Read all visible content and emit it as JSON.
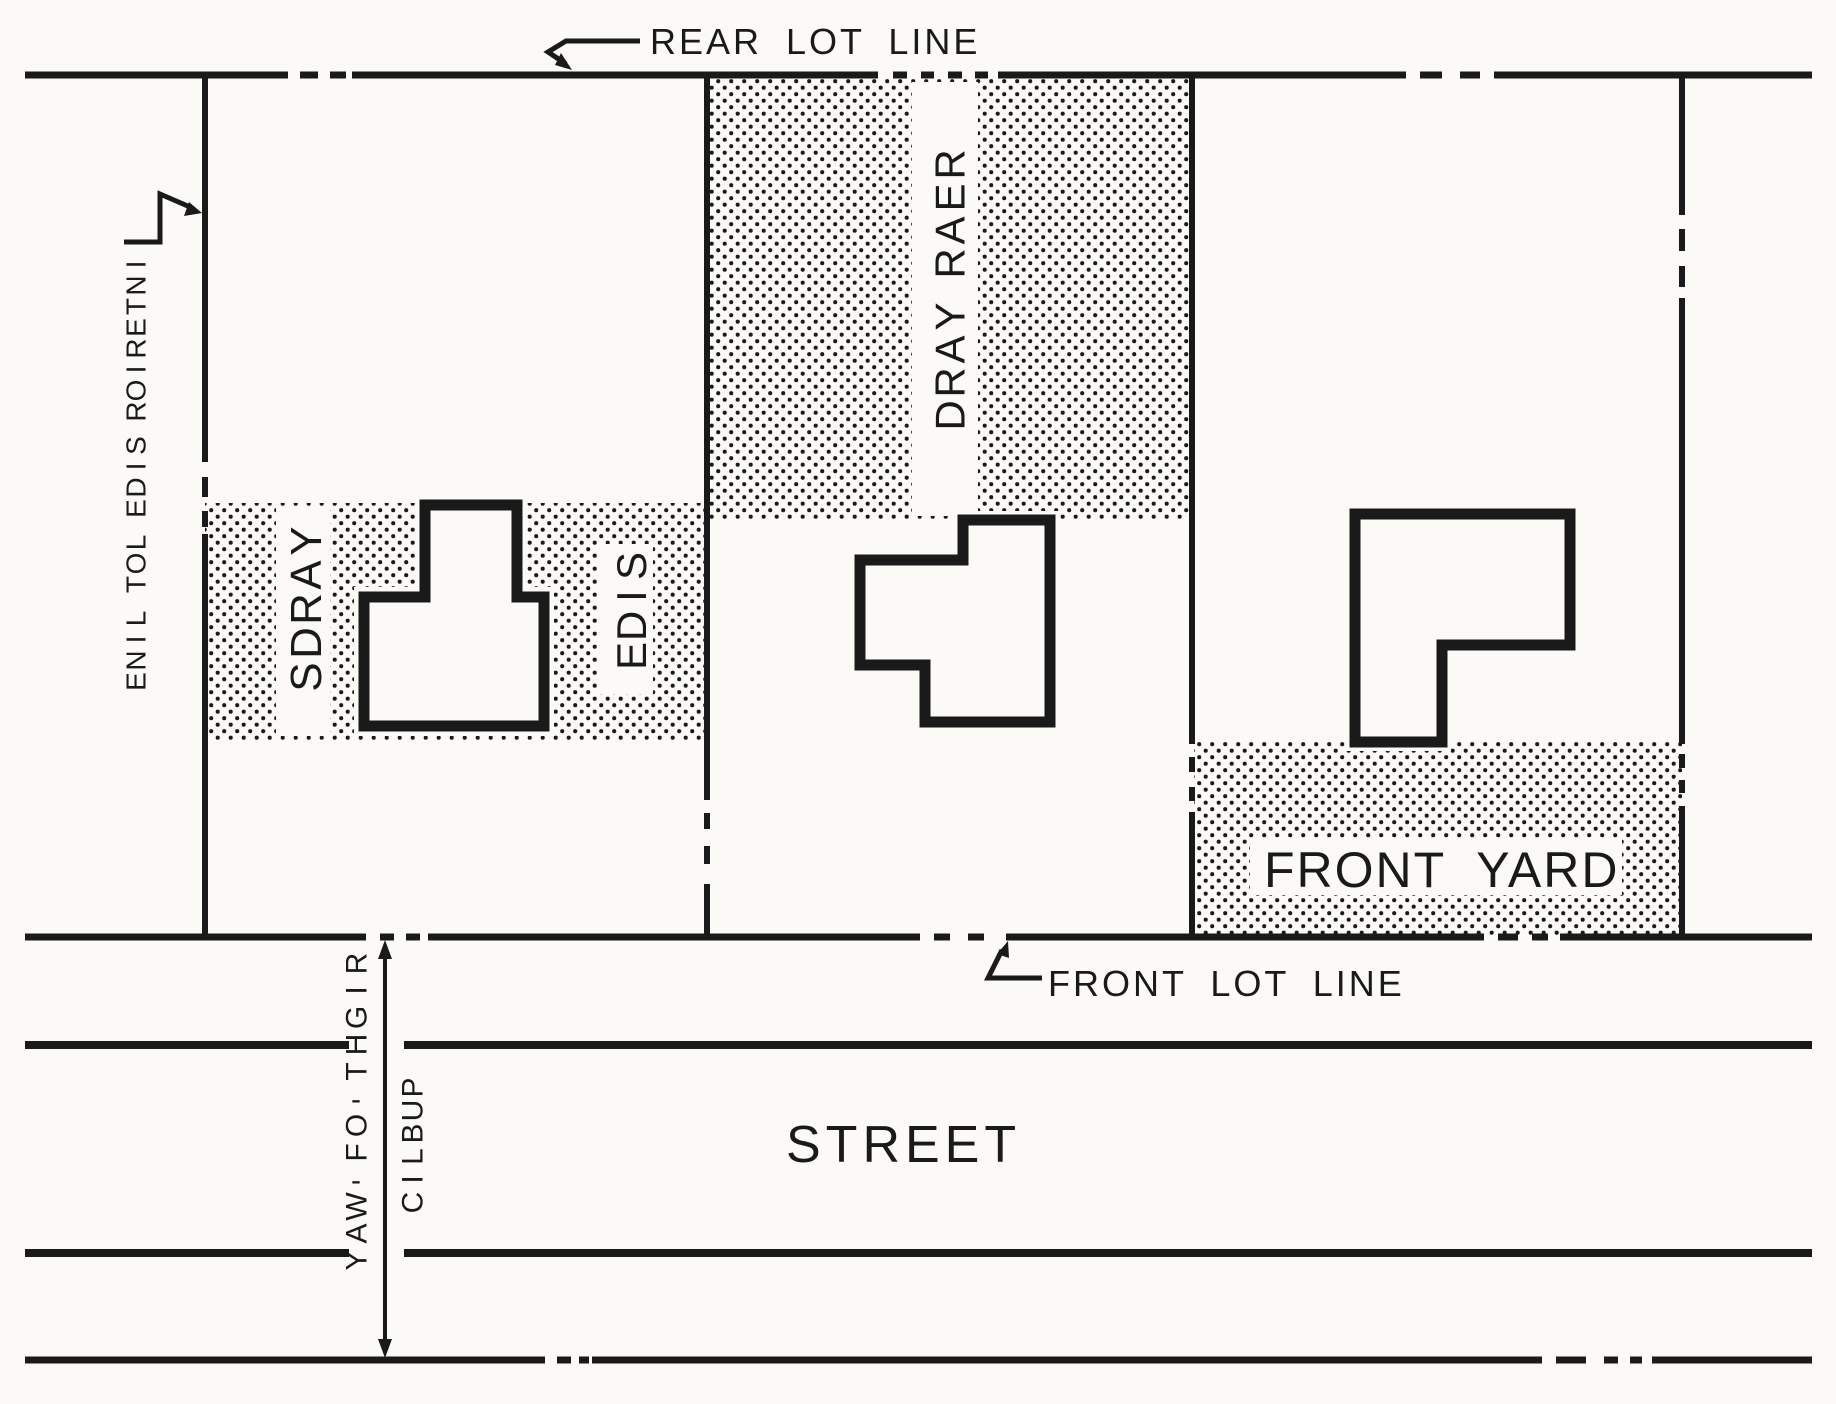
{
  "title": "Lot line and yard requirements diagram",
  "labels": {
    "rear_lot_line": "REAR LOT LINE",
    "interior_side_lot_line": "INTERIOR SIDE LOT LINE",
    "yards": "YARDS",
    "side": "SIDE",
    "rear_yard": "REAR YARD",
    "front_yard": "FRONT YARD",
    "front_lot_line": "FRONT LOT LINE",
    "street": "STREET",
    "public": "PUBLIC",
    "right_of_way": "RIGHT-OF-WAY"
  },
  "colors": {
    "ink": "#1a1a1a",
    "paper": "#fbfaf7"
  }
}
